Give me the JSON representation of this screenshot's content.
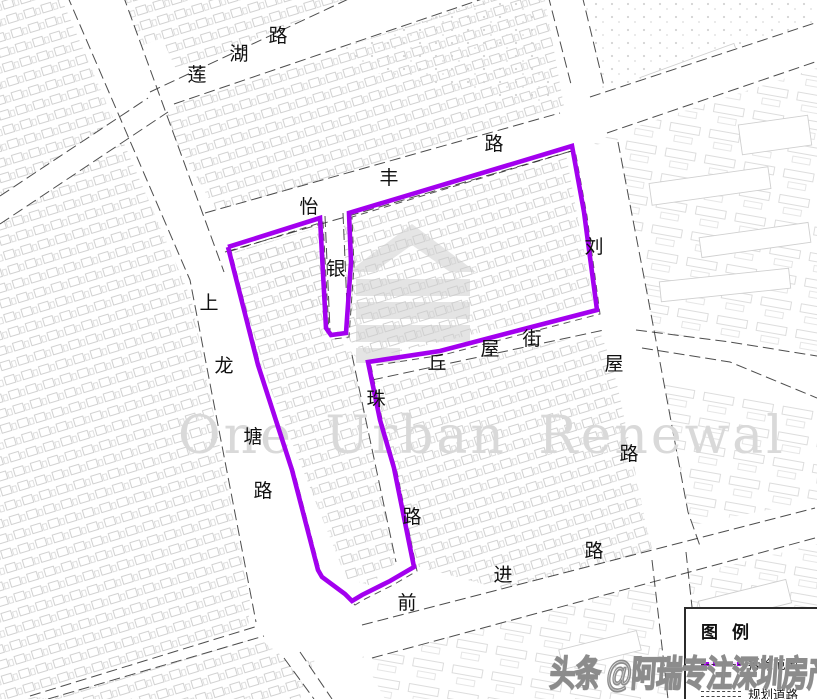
{
  "map": {
    "center_watermark": "One Urban Renewal",
    "bottom_watermark": "头条 @阿瑞专注深圳房产",
    "colors": {
      "boundary": "#a300ef",
      "road_edge": "#2e2e2e",
      "building_outline": "#c7c7c7",
      "label": "#101010",
      "watermark_gray": "#d9d9d9"
    },
    "legend": {
      "title": "图例",
      "items": [
        {
          "id": "demolition-scope",
          "label": "拆除范围",
          "symbol": "purple-dashed-line"
        },
        {
          "id": "planned-road",
          "label": "规划道路",
          "symbol": "parallel-dashed-lines"
        }
      ]
    },
    "road_labels": [
      {
        "id": "lianhu-road",
        "name": "莲湖路",
        "chars": [
          [
            "莲",
            197,
            74
          ],
          [
            "湖",
            239,
            53
          ],
          [
            "路",
            278,
            35
          ]
        ]
      },
      {
        "id": "yifeng-road",
        "name": "怡丰路",
        "chars": [
          [
            "怡",
            309,
            206
          ],
          [
            "丰",
            389,
            177
          ],
          [
            "路",
            494,
            143
          ]
        ]
      },
      {
        "id": "shanglongtang-road",
        "name": "上龙塘路",
        "chars": [
          [
            "上",
            209,
            302
          ],
          [
            "龙",
            224,
            365
          ],
          [
            "塘",
            253,
            436
          ],
          [
            "路",
            263,
            490
          ]
        ]
      },
      {
        "id": "yin-street",
        "name": "银",
        "chars": [
          [
            "银",
            336,
            268
          ]
        ]
      },
      {
        "id": "liuwu-road",
        "name": "刘屋路",
        "chars": [
          [
            "刘",
            594,
            246
          ],
          [
            "屋",
            614,
            363
          ],
          [
            "路",
            629,
            453
          ]
        ]
      },
      {
        "id": "qiuwu-street",
        "name": "丘屋街",
        "chars": [
          [
            "丘",
            437,
            362
          ],
          [
            "屋",
            490,
            348
          ],
          [
            "街",
            532,
            338
          ]
        ]
      },
      {
        "id": "zhu-road",
        "name": "珠路",
        "chars": [
          [
            "珠",
            376,
            398
          ],
          [
            "路",
            412,
            516
          ]
        ]
      },
      {
        "id": "qianjin-road",
        "name": "前进路",
        "chars": [
          [
            "前",
            407,
            602
          ],
          [
            "进",
            503,
            574
          ],
          [
            "路",
            594,
            550
          ]
        ]
      }
    ],
    "boundary": {
      "label": "拆除范围",
      "color": "#a300ef",
      "points": [
        [
          228,
          247
        ],
        [
          320,
          218
        ],
        [
          326,
          328
        ],
        [
          331,
          335
        ],
        [
          346,
          333
        ],
        [
          351,
          262
        ],
        [
          349,
          213
        ],
        [
          572,
          146
        ],
        [
          584,
          212
        ],
        [
          597,
          310
        ],
        [
          520,
          330
        ],
        [
          440,
          351
        ],
        [
          368,
          362
        ],
        [
          380,
          420
        ],
        [
          394,
          468
        ],
        [
          414,
          567
        ],
        [
          390,
          581
        ],
        [
          362,
          595
        ],
        [
          352,
          601
        ],
        [
          345,
          594
        ],
        [
          322,
          577
        ],
        [
          318,
          570
        ],
        [
          292,
          470
        ],
        [
          258,
          365
        ],
        [
          228,
          247
        ]
      ]
    }
  }
}
